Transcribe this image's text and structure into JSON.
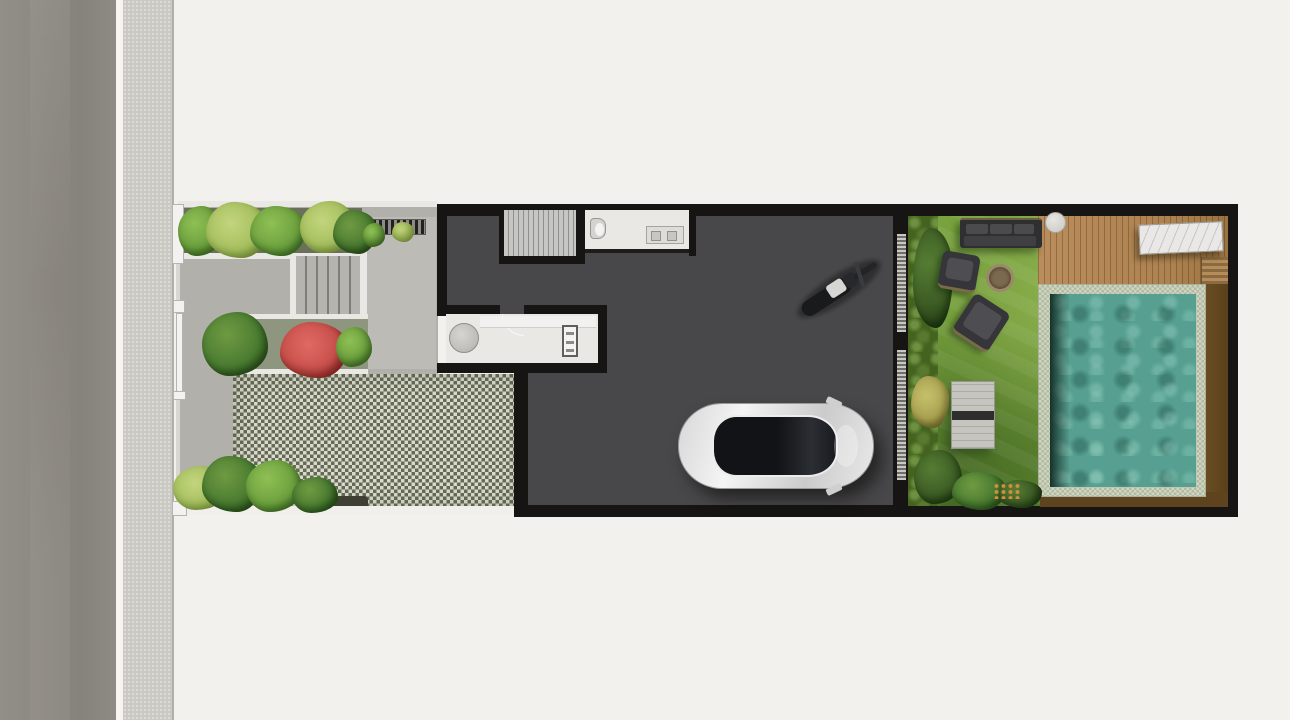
{
  "page": {
    "title": "Residential lot floor plan — top-down 3D render",
    "type": "architectural-site-plan",
    "visible_text": "none"
  },
  "colors": {
    "background": "#f2f1ee",
    "road": "#8c8883",
    "curb_white": "#f6f5f2",
    "sidewalk": "#cbc9c3",
    "paving": "#b2b0ab",
    "paving_light": "#bdbbb6",
    "curb_edge": "#e9e8e4",
    "soil_dark": "#3d4032",
    "checker_light": "#d9d9cf",
    "checker_dark": "#656b53",
    "wall": "#161514",
    "garage_floor": "#48484a",
    "stairs": "#b6b4af",
    "stairs_light": "#c6c6c4",
    "room_floor": "#e9e8e5",
    "fixture": "#d4d3d0",
    "bike_dark": "#191a1c",
    "bike_seat": "#d6d6d4",
    "gate_slat_light": "#c9c8c4",
    "gate_slat_dark": "#6e6d6a",
    "grass": "#7aa43f",
    "grass_dark": "#618a31",
    "hedge": "#44631f",
    "deck_wood": "#b98e5c",
    "wood_dark": "#66491f",
    "pool_tile": "#cfd5c0",
    "pool_water": "#57a091",
    "sofa_dark": "#2f2f31",
    "sofa_mid": "#4b4b4d",
    "marble": "#e9e8e6",
    "white_trim": "#f3f2f0",
    "flower_red": "#c8504c",
    "bush_yellow": "#a8a14f",
    "car_body": "#e8e8e8",
    "car_glass": "#131416"
  },
  "regions": [
    {
      "name": "street",
      "kind": "asphalt road, left edge"
    },
    {
      "name": "sidewalk",
      "kind": "light paved footpath with curb"
    },
    {
      "name": "front-garden",
      "kind": "gray paved yard with planting beds, entry steps, red flowering shrub"
    },
    {
      "name": "grass-block-paving",
      "kind": "green/white checkered permeable driveway pad"
    },
    {
      "name": "house",
      "kind": "dark-floor ground level with staircase, bathroom, kitchen counter"
    },
    {
      "name": "garage",
      "kind": "dark concrete floor with white car and motorcycle"
    },
    {
      "name": "slatted-gate",
      "kind": "divider wall between garage and backyard"
    },
    {
      "name": "backyard",
      "kind": "lawn with outdoor sofa, chairs, fire pit, sun lounger"
    },
    {
      "name": "wood-deck",
      "kind": "timber deck with round side table and marble dining table"
    },
    {
      "name": "swimming-pool",
      "kind": "teal tiled pool with light coping and wood surround"
    }
  ]
}
